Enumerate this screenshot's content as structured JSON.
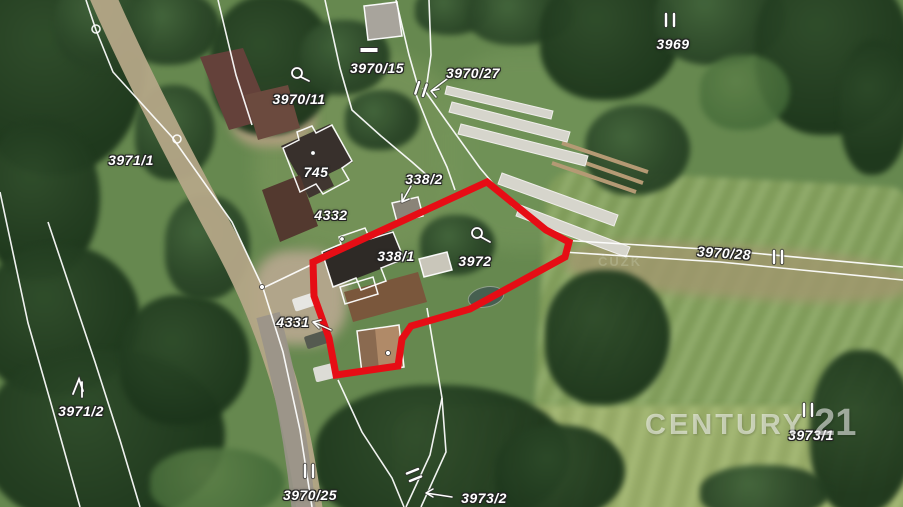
{
  "map": {
    "kind": "cadastral parcel overlay on aerial photo",
    "colors": {
      "boundary-red": "#e60d15",
      "cadastral-white": "#ffffff"
    },
    "watermark": {
      "word": "CENTURY",
      "number": "21"
    },
    "cadastre_watermark": "ČÚZK",
    "parcel_labels": [
      {
        "text": "3969",
        "x": 673,
        "y": 44
      },
      {
        "text": "3970/15",
        "x": 377,
        "y": 68
      },
      {
        "text": "3970/27",
        "x": 473,
        "y": 73
      },
      {
        "text": "3970/11",
        "x": 299,
        "y": 99
      },
      {
        "text": "3971/1",
        "x": 131,
        "y": 160
      },
      {
        "text": "745",
        "x": 316,
        "y": 172
      },
      {
        "text": "338/2",
        "x": 424,
        "y": 179
      },
      {
        "text": "4332",
        "x": 331,
        "y": 215
      },
      {
        "text": "338/1",
        "x": 396,
        "y": 256
      },
      {
        "text": "3972",
        "x": 475,
        "y": 261
      },
      {
        "text": "3970/28",
        "x": 724,
        "y": 253,
        "rot": 4
      },
      {
        "text": "4331",
        "x": 293,
        "y": 322
      },
      {
        "text": "3971/2",
        "x": 81,
        "y": 411
      },
      {
        "text": "3973/1",
        "x": 811,
        "y": 435
      },
      {
        "text": "3970/25",
        "x": 310,
        "y": 495
      },
      {
        "text": "3973/2",
        "x": 484,
        "y": 498
      }
    ],
    "symbol_legend": {
      "double-tick": "‖ boundary marker",
      "well-symbol": "○ circle with tail",
      "dash-symbol": "— short bar",
      "tree-symbol": "⋀ scrub/forest mark",
      "leader-arrow": "→ label leader",
      "boundary-dot": "• survey point"
    },
    "double_ticks": [
      {
        "x": 670,
        "y": 20,
        "rot": 0
      },
      {
        "x": 421,
        "y": 89,
        "rot": 18
      },
      {
        "x": 778,
        "y": 257,
        "rot": 0
      },
      {
        "x": 808,
        "y": 410,
        "rot": 0
      },
      {
        "x": 309,
        "y": 471,
        "rot": 0
      },
      {
        "x": 414,
        "y": 475,
        "rot": 68
      }
    ]
  }
}
